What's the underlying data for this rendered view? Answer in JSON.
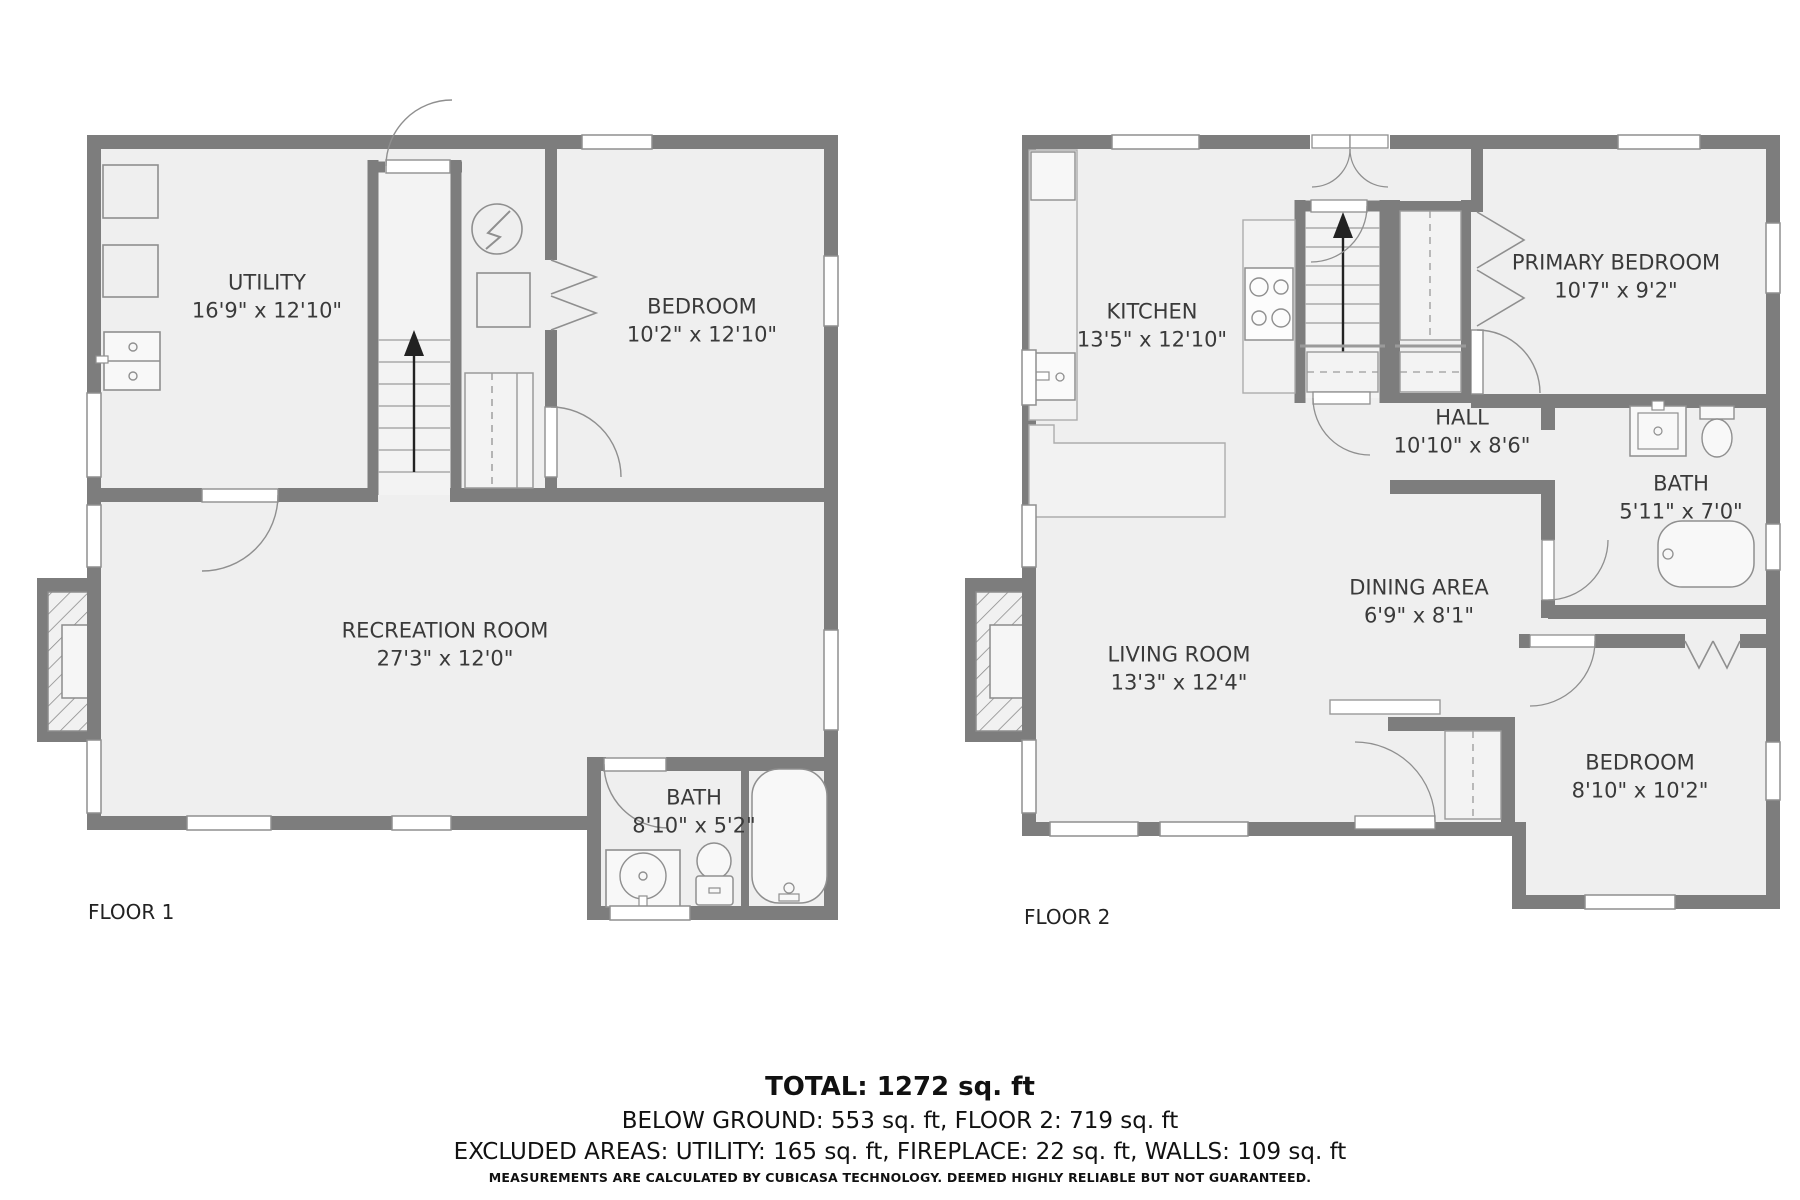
{
  "floors": [
    {
      "label": "FLOOR 1",
      "rooms": [
        {
          "name": "UTILITY",
          "dims": "16'9\" x 12'10\""
        },
        {
          "name": "BEDROOM",
          "dims": "10'2\" x 12'10\""
        },
        {
          "name": "RECREATION ROOM",
          "dims": "27'3\" x 12'0\""
        },
        {
          "name": "BATH",
          "dims": "8'10\" x 5'2\""
        }
      ]
    },
    {
      "label": "FLOOR 2",
      "rooms": [
        {
          "name": "KITCHEN",
          "dims": "13'5\" x 12'10\""
        },
        {
          "name": "PRIMARY BEDROOM",
          "dims": "10'7\" x 9'2\""
        },
        {
          "name": "HALL",
          "dims": "10'10\" x 8'6\""
        },
        {
          "name": "BATH",
          "dims": "5'11\" x 7'0\""
        },
        {
          "name": "DINING AREA",
          "dims": "6'9\" x 8'1\""
        },
        {
          "name": "LIVING ROOM",
          "dims": "13'3\" x 12'4\""
        },
        {
          "name": "BEDROOM",
          "dims": "8'10\" x 10'2\""
        }
      ]
    }
  ],
  "summary": {
    "total": "TOTAL: 1272 sq. ft",
    "by_floor": "BELOW GROUND: 553 sq. ft, FLOOR 2: 719 sq. ft",
    "excluded": "EXCLUDED AREAS: UTILITY: 165 sq. ft, FIREPLACE: 22 sq. ft, WALLS: 109 sq. ft",
    "disclaimer": "MEASUREMENTS ARE CALCULATED BY CUBICASA TECHNOLOGY. DEEMED HIGHLY RELIABLE BUT NOT GUARANTEED."
  },
  "colors": {
    "wall": "#7d7d7d",
    "floor": "#efefef",
    "line": "#999999",
    "text": "#3a3a3a"
  }
}
